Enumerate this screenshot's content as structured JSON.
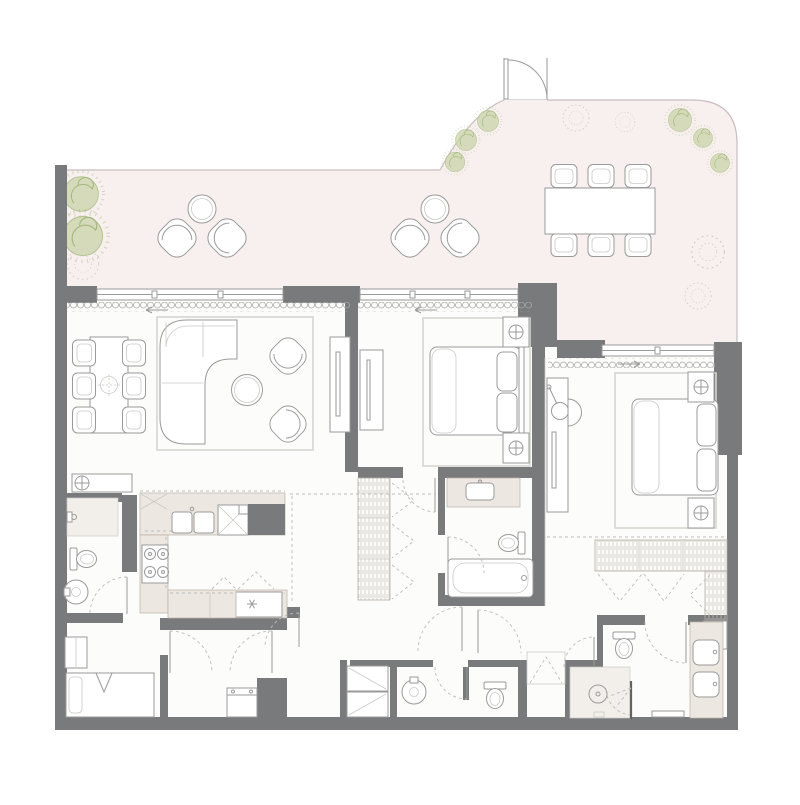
{
  "document": {
    "kind": "architectural-floor-plan",
    "description": "Residential apartment floor plan with large wrap-around terrace, visible text labels: none",
    "visible_text": []
  },
  "palette": {
    "bg": "#ffffff",
    "wall": "#797a7c",
    "terrace": "#f8f0ef",
    "room": "#fcfcfa",
    "beige": "#ece7e0",
    "fline": "#9a9a9a",
    "lline": "#c9c9c6",
    "dash": "#bcbcbc",
    "pfill": "#cdd7ae",
    "pstroke": "#a4b77d",
    "rug": "#d6d5d0",
    "tedge": "#c9bdbd",
    "glass": "#636363"
  },
  "rooms": [
    {
      "name": "terrace",
      "furniture": [
        "outdoor dining table",
        "6 outdoor dining chairs",
        "2 lounge-chair pairs with round side tables",
        "planter shrubs",
        "entry door"
      ]
    },
    {
      "name": "living-dining-room",
      "furniture": [
        "dining table",
        "6 dining chairs",
        "L-shaped sofa",
        "round coffee table",
        "2 armchairs",
        "area rug",
        "tv sideboard",
        "fan-coil unit"
      ]
    },
    {
      "name": "kitchen",
      "furniture": [
        "U-shaped counter",
        "double sink",
        "4-burner cooktop",
        "tall cabinet",
        "refrigerator",
        "service column"
      ]
    },
    {
      "name": "bedroom-2",
      "furniture": [
        "double bed",
        "2 bedside units",
        "area rug",
        "tv panel",
        "wardrobe"
      ]
    },
    {
      "name": "bathroom-2",
      "furniture": [
        "vanity with basin",
        "toilet",
        "bathtub"
      ]
    },
    {
      "name": "master-bedroom",
      "furniture": [
        "double bed",
        "2 bedside units",
        "area rug",
        "dressing table with mirror and chair",
        "tv panel"
      ]
    },
    {
      "name": "master-closet",
      "furniture": [
        "L-shaped wardrobe run"
      ]
    },
    {
      "name": "master-bathroom",
      "furniture": [
        "toilet compartment",
        "walk-in shower",
        "double vanity",
        "bench"
      ]
    },
    {
      "name": "powder-room",
      "furniture": [
        "round basin",
        "toilet"
      ]
    },
    {
      "name": "maid-room",
      "furniture": [
        "single bed",
        "wardrobe"
      ]
    },
    {
      "name": "bathroom-1",
      "furniture": [
        "shower",
        "toilet",
        "round basin"
      ]
    },
    {
      "name": "hallway",
      "furniture": [
        "washing machine",
        "stacked laundry closet",
        "storage closet"
      ]
    }
  ]
}
